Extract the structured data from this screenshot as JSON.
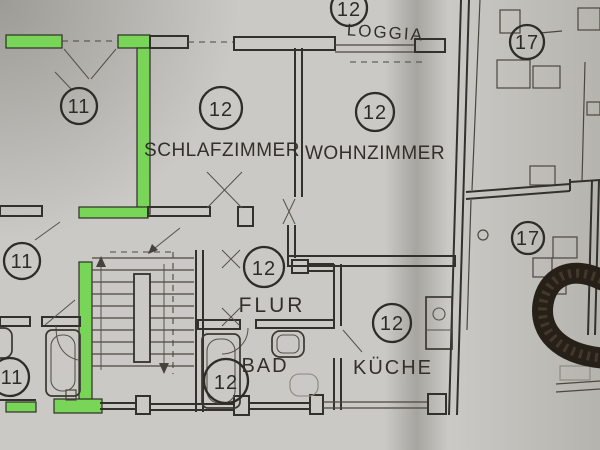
{
  "plan": {
    "colors": {
      "paper": "#cac9c5",
      "ink": "#33312c",
      "highlight": "#79d558",
      "cord": "#262019",
      "cord_braid": "#4a4030"
    },
    "rooms": [
      {
        "id": "loggia",
        "number": "12",
        "label": "LOGGIA"
      },
      {
        "id": "room-top-left",
        "number": "11",
        "label": ""
      },
      {
        "id": "schlafzimmer",
        "number": "12",
        "label": "SCHLAFZIMMER"
      },
      {
        "id": "wohnzimmer",
        "number": "12",
        "label": "WOHNZIMMER"
      },
      {
        "id": "unit-17-upper",
        "number": "17",
        "label": ""
      },
      {
        "id": "room-mid-left",
        "number": "11",
        "label": ""
      },
      {
        "id": "flur",
        "number": "12",
        "label": "FLUR"
      },
      {
        "id": "unit-17-lower",
        "number": "17",
        "label": ""
      },
      {
        "id": "kueche",
        "number": "12",
        "label": "KÜCHE"
      },
      {
        "id": "bad",
        "number": "12",
        "label": "BAD"
      },
      {
        "id": "room-bottom-left",
        "number": "11",
        "label": ""
      }
    ]
  }
}
